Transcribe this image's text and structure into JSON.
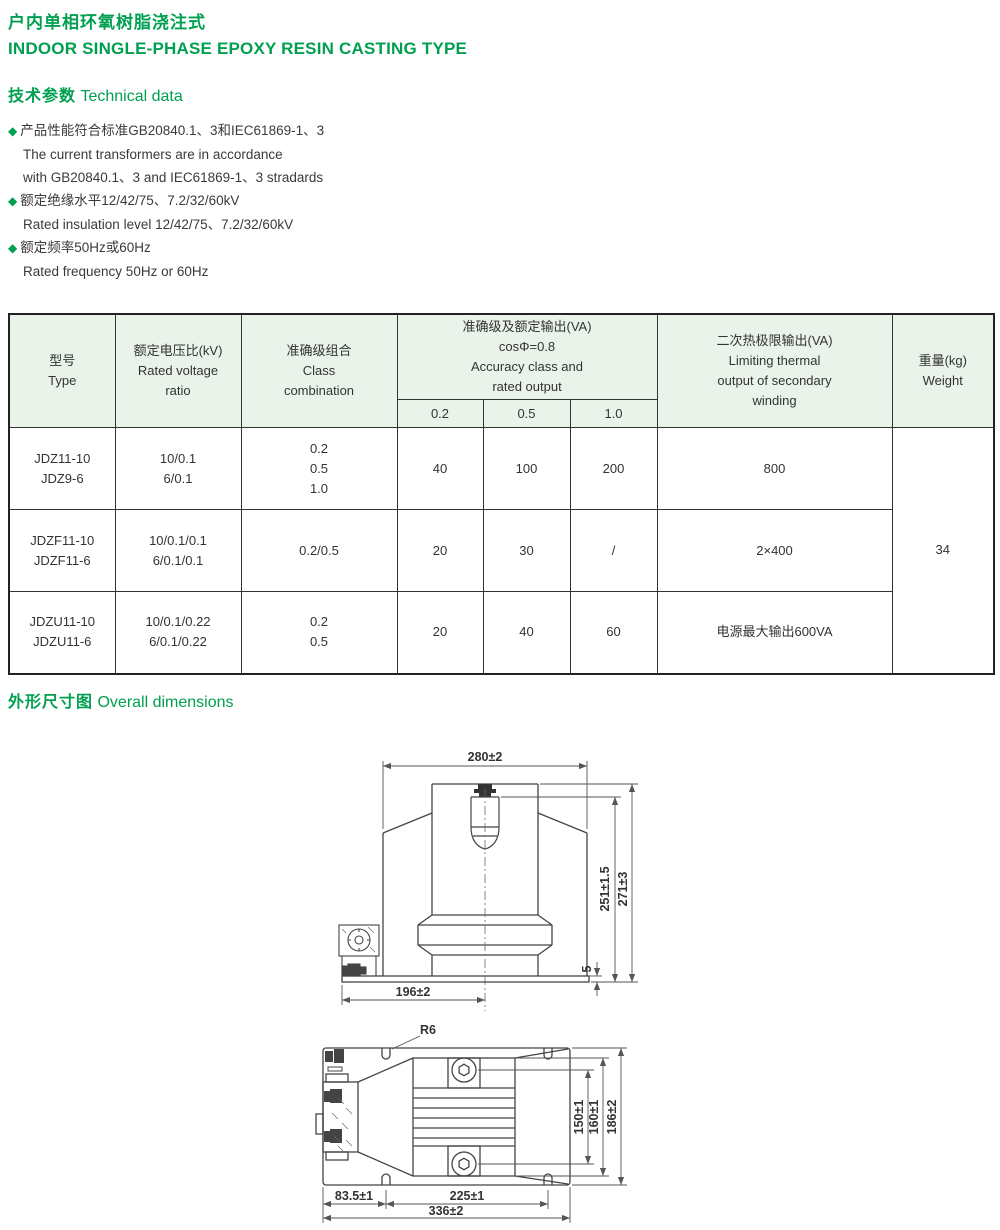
{
  "header": {
    "title_zh": "户内单相环氧树脂浇注式",
    "title_en": "INDOOR SINGLE-PHASE EPOXY RESIN CASTING TYPE"
  },
  "sections": {
    "technical_zh": "技术参数",
    "technical_en": "Technical data",
    "dimensions_zh": "外形尺寸图",
    "dimensions_en": "Overall dimensions"
  },
  "bullet_glyph": "◆",
  "features": [
    {
      "lines": [
        "产品性能符合标准GB20840.1、3和IEC61869-1、3",
        "The current transformers are in accordance",
        "with GB20840.1、3 and IEC61869-1、3 stradards"
      ]
    },
    {
      "lines": [
        "额定绝缘水平12/42/75、7.2/32/60kV",
        "Rated insulation level 12/42/75、7.2/32/60kV"
      ]
    },
    {
      "lines": [
        "额定频率50Hz或60Hz",
        "Rated frequency 50Hz or 60Hz"
      ]
    }
  ],
  "table": {
    "header": {
      "type": [
        "型号",
        "Type"
      ],
      "voltage": [
        "额定电压比(kV)",
        "Rated voltage",
        "ratio"
      ],
      "class": [
        "准确级组合",
        "Class",
        "combination"
      ],
      "accuracy": [
        "准确级及额定输出(VA)",
        "cosΦ=0.8",
        "Accuracy class and",
        "rated output"
      ],
      "accuracy_sub": [
        "0.2",
        "0.5",
        "1.0"
      ],
      "thermal": [
        "二次热极限输出(VA)",
        "Limiting thermal",
        "output of secondary",
        "winding"
      ],
      "weight": [
        "重量(kg)",
        "Weight"
      ]
    },
    "rows": [
      {
        "type": [
          "JDZ11-10",
          "JDZ9-6"
        ],
        "voltage": [
          "10/0.1",
          "6/0.1"
        ],
        "class": [
          "0.2",
          "0.5",
          "1.0"
        ],
        "va02": "40",
        "va05": "100",
        "va10": "200",
        "thermal": "800"
      },
      {
        "type": [
          "JDZF11-10",
          "JDZF11-6"
        ],
        "voltage": [
          "10/0.1/0.1",
          "6/0.1/0.1"
        ],
        "class": [
          "0.2/0.5"
        ],
        "va02": "20",
        "va05": "30",
        "va10": "/",
        "thermal": "2×400"
      },
      {
        "type": [
          "JDZU11-10",
          "JDZU11-6"
        ],
        "voltage": [
          "10/0.1/0.22",
          "6/0.1/0.22"
        ],
        "class": [
          "0.2",
          "0.5"
        ],
        "va02": "20",
        "va05": "40",
        "va10": "60",
        "thermal": "电源最大输出600VA"
      }
    ],
    "weight_value": "34"
  },
  "drawings": {
    "front": {
      "width_top": "280±2",
      "base_width": "196±2",
      "height_inner": "251±1.5",
      "height_outer": "271±3",
      "base_plate": "5"
    },
    "top": {
      "fillet_radius": "R6",
      "boss_span": "150±1",
      "body_height": "160±1",
      "overall_height": "186±2",
      "edge_to_slot": "83.5±1",
      "slot_span": "225±1",
      "overall_width": "336±2"
    }
  },
  "colors": {
    "accent_green": "#00a050",
    "table_header_bg": "#e9f3ea",
    "drawing_line": "#444444"
  }
}
